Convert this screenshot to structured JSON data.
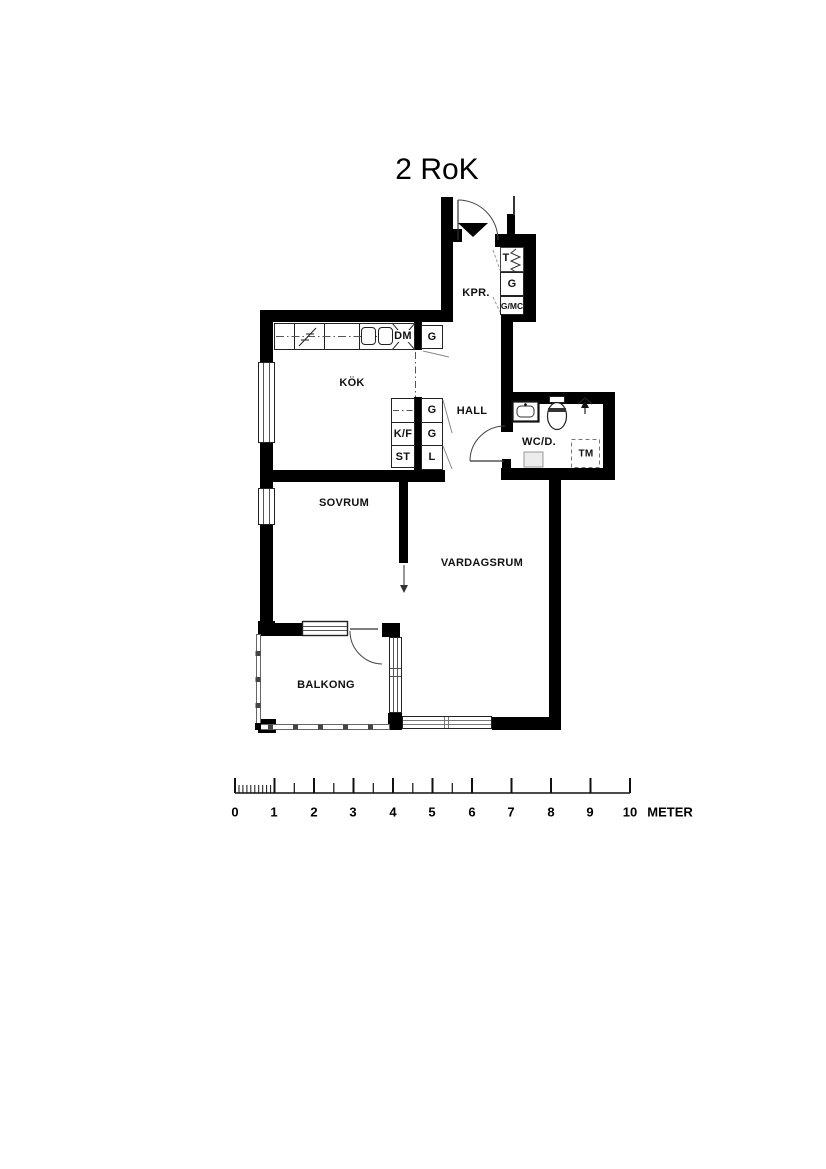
{
  "title": "2 RoK",
  "rooms": {
    "kpr": "KPR.",
    "kok": "KÖK",
    "hall": "HALL",
    "wcd": "WC/D.",
    "sovrum": "SOVRUM",
    "vardagsrum": "VARDAGSRUM",
    "balkong": "BALKONG"
  },
  "fixtures": {
    "dm": "DM",
    "g_top": "G",
    "t": "T",
    "g_kpr": "G",
    "gmc": "G/MC",
    "kf": "K/F",
    "st": "ST",
    "g_hall_1": "G",
    "g_hall_2": "G",
    "l": "L",
    "tm": "TM"
  },
  "icons": {
    "entrance": "entrance-arrow-icon",
    "stove": "stove-icon",
    "sink": "sink-icon",
    "dishwasher": "dishwasher-cross-icon",
    "drying_cabinet": "heater-zigzag-icon",
    "toilet": "toilet-icon",
    "washbasin": "washbasin-icon",
    "shower": "shower-drain-icon",
    "opening_arrow": "opening-direction-arrow-icon"
  },
  "scale": {
    "labels": [
      "0",
      "1",
      "2",
      "3",
      "4",
      "5",
      "6",
      "7",
      "8",
      "9",
      "10"
    ],
    "unit": "METER"
  },
  "colors": {
    "wall": "#000000",
    "line": "#222222",
    "background": "#ffffff"
  }
}
